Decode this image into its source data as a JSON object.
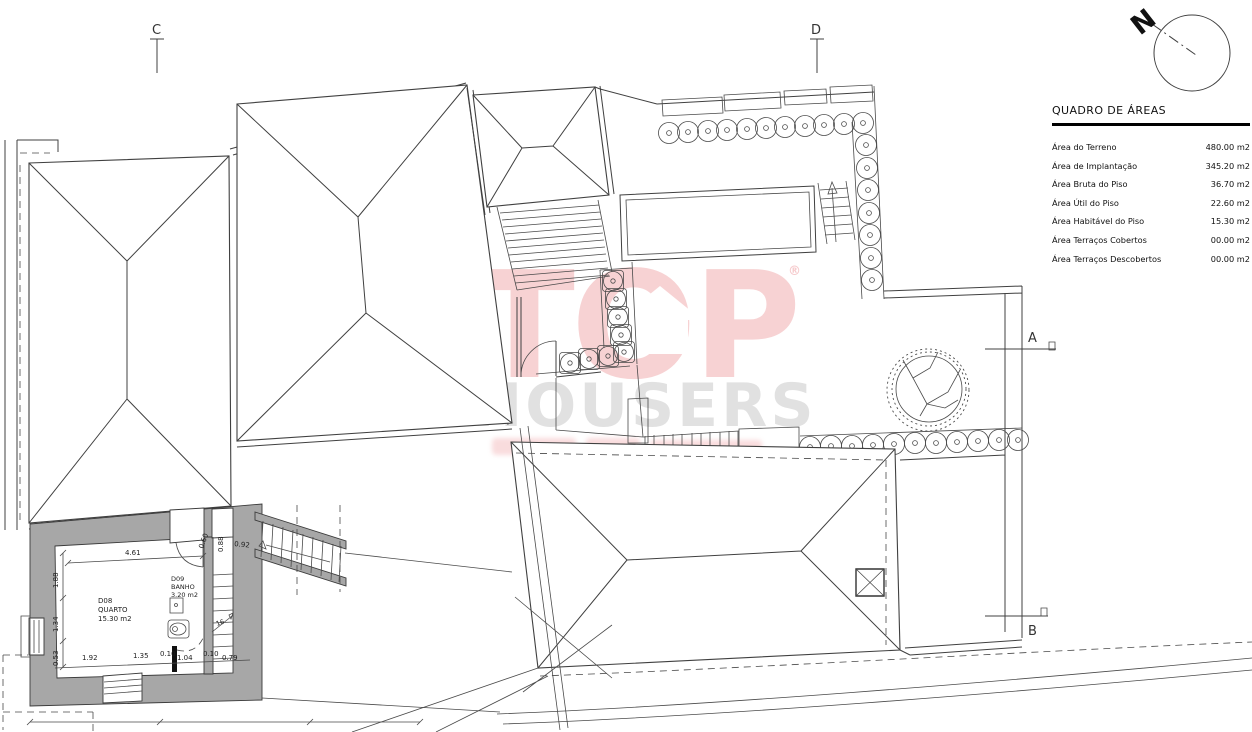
{
  "north_label": "N",
  "section_markers": {
    "c": "C",
    "d": "D",
    "a": "A",
    "b": "B"
  },
  "area_table": {
    "title": "QUADRO DE ÁREAS",
    "rows": [
      {
        "label": "Área do Terreno",
        "value": "480.00 m2"
      },
      {
        "label": "Área de Implantação",
        "value": "345.20 m2"
      },
      {
        "label": "Área Bruta do Piso",
        "value": "36.70 m2"
      },
      {
        "label": "Área Útil do Piso",
        "value": "22.60 m2"
      },
      {
        "label": "Área Habitável do Piso",
        "value": "15.30 m2"
      },
      {
        "label": "Área Terraços Cobertos",
        "value": "00.00 m2"
      },
      {
        "label": "Área Terraços Descobertos",
        "value": "00.00 m2"
      }
    ]
  },
  "watermark": {
    "brand_top": "TOP",
    "brand_bottom": "HOUSERS",
    "registered": "®"
  },
  "rooms": {
    "quarto": {
      "code": "D08",
      "name": "QUARTO",
      "area": "15.30 m2"
    },
    "banho": {
      "code": "D09",
      "name": "BANHO",
      "area": "3.20 m2"
    }
  },
  "stairs": {
    "step_label": "16"
  },
  "dimensions": {
    "room_width": "4.61",
    "left": [
      "1.88",
      "1.34",
      "0.53"
    ],
    "bottom": [
      "1.92",
      "1.35",
      "0.10",
      "1.04",
      "0.10",
      "0.79"
    ],
    "top_right": [
      "0.60",
      "0.88",
      "0.92"
    ]
  },
  "colors": {
    "accent_red": "#e25056",
    "wall_gray": "#a7a7a7",
    "line": "#404040"
  }
}
